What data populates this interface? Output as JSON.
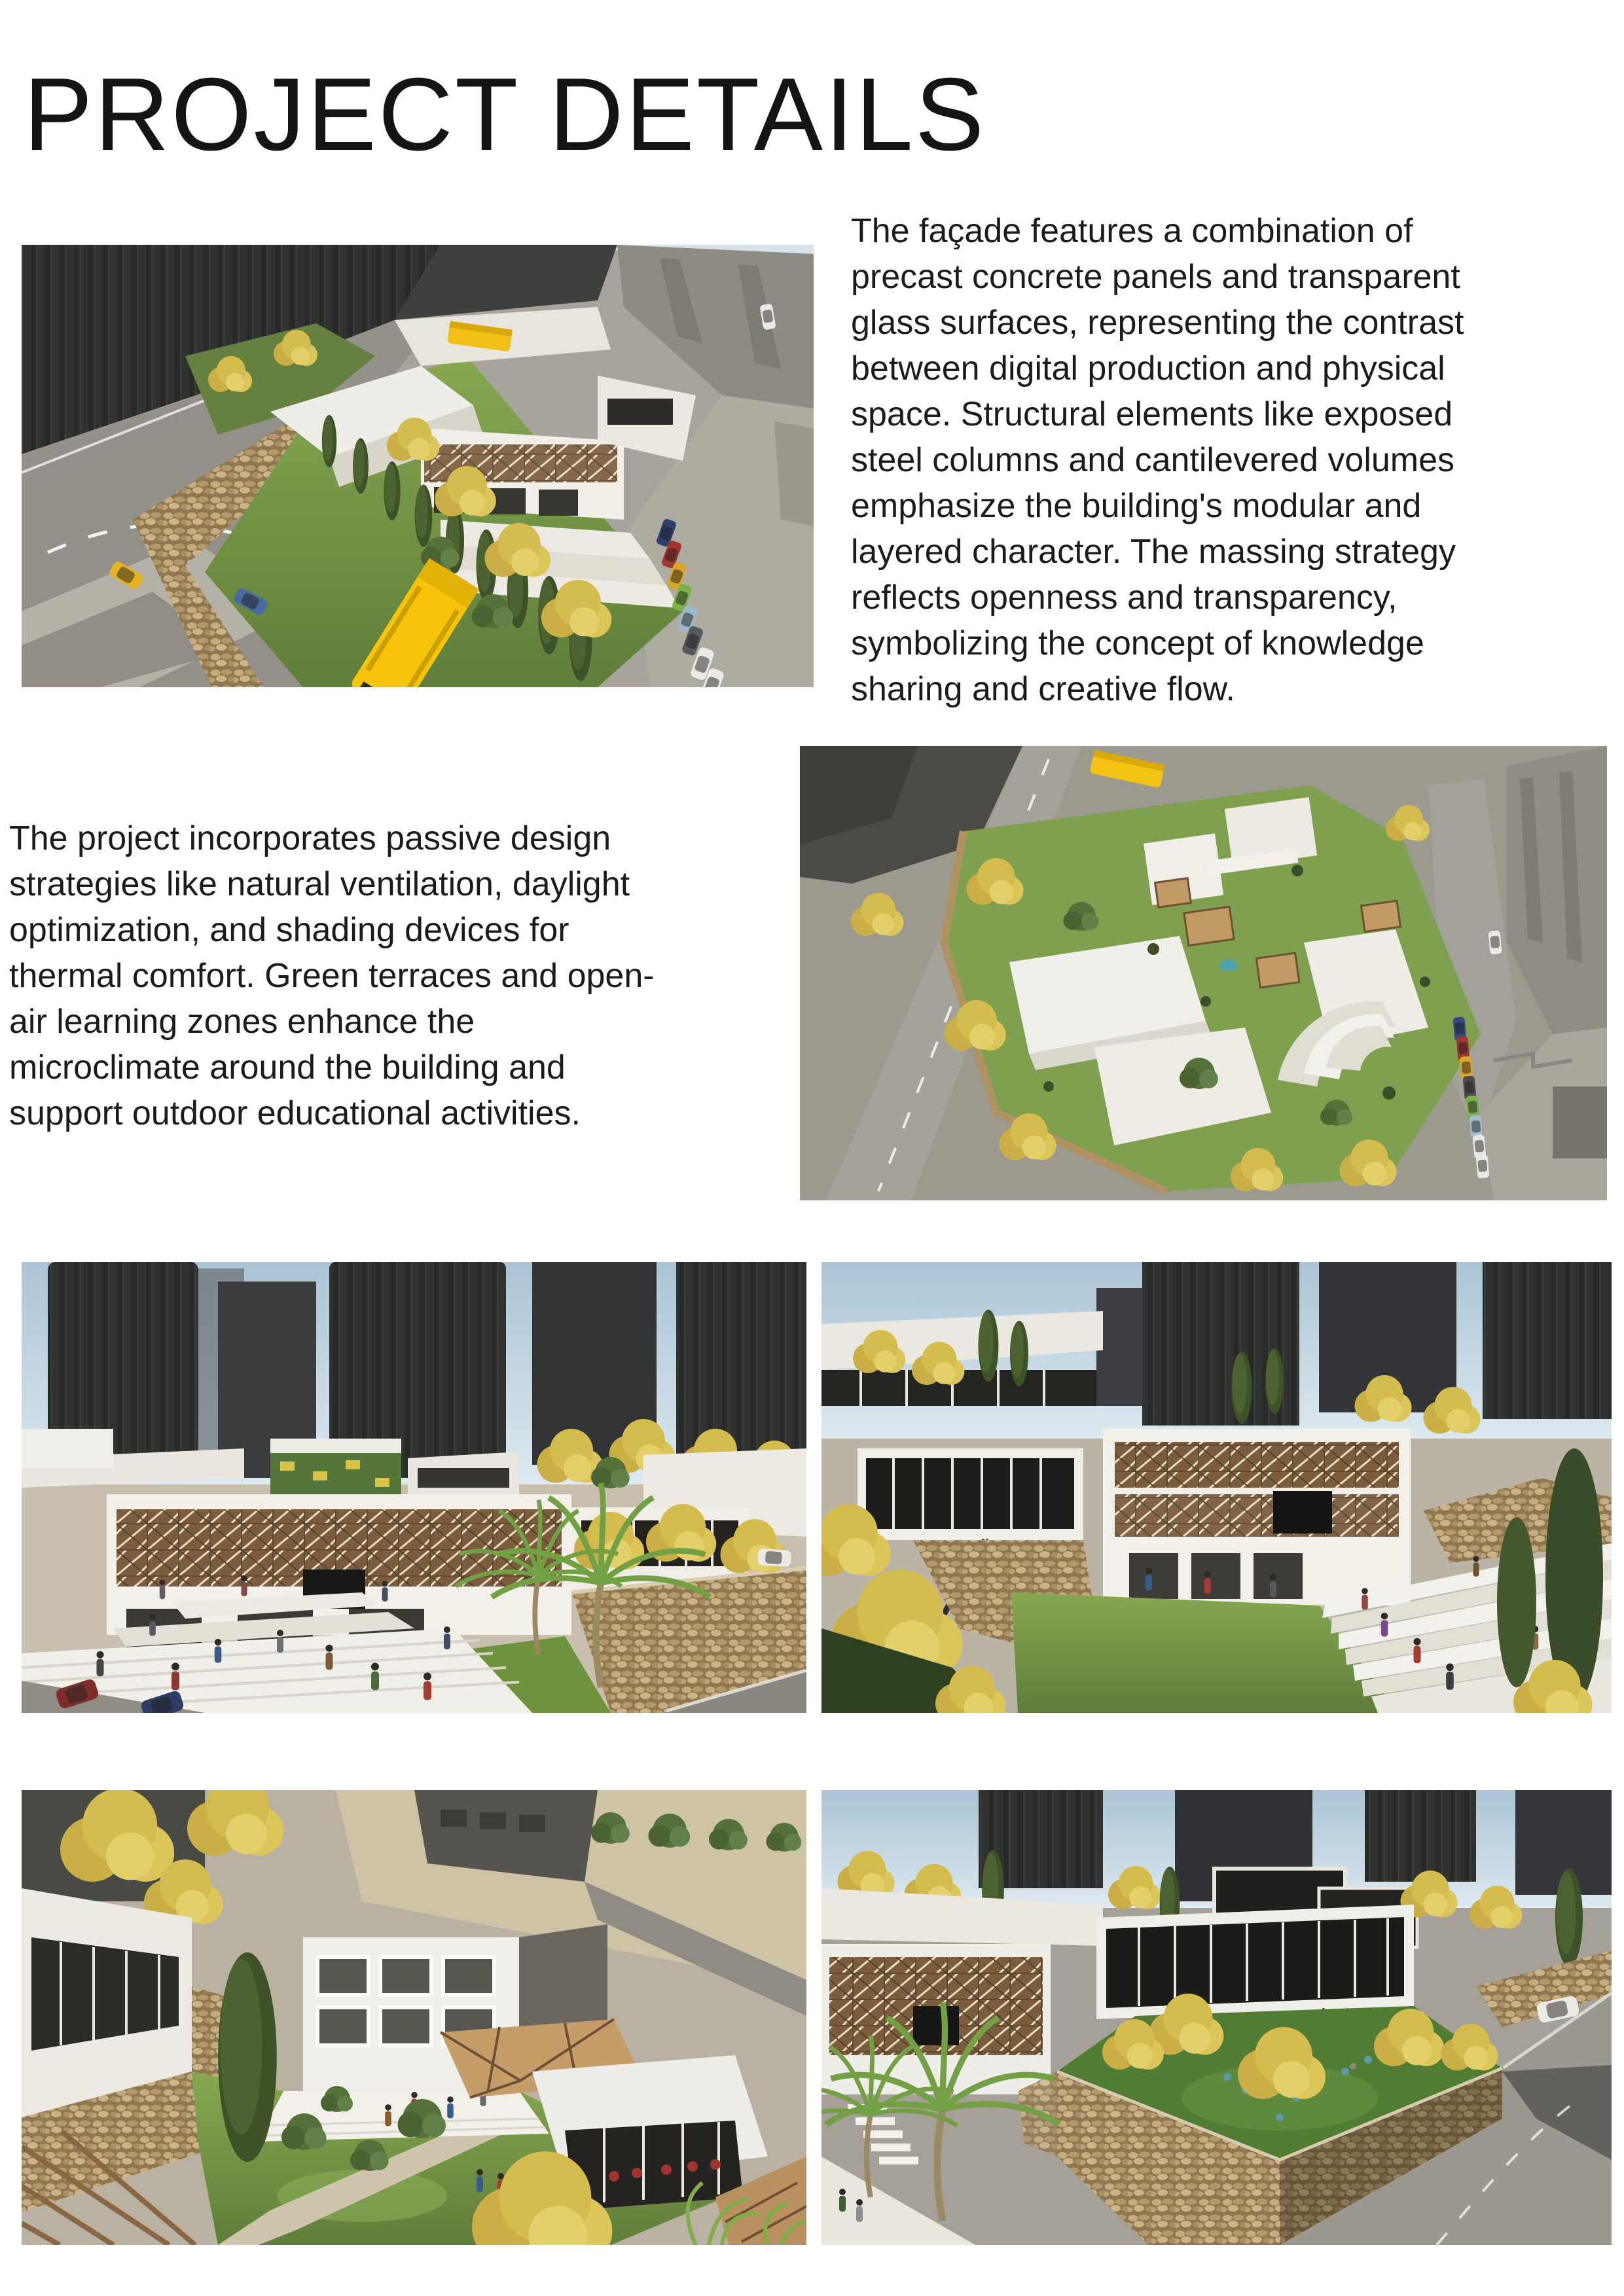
{
  "page": {
    "title": "PROJECT DETAILS"
  },
  "paragraphs": {
    "facade_lines": [
      "The façade features a combination of",
      "precast concrete panels and transparent",
      "glass surfaces, representing the contrast",
      "between digital production and physical",
      "space. Structural elements like exposed",
      "steel columns and cantilevered volumes",
      "emphasize the building's modular and",
      "layered character. The massing strategy",
      "reflects openness and transparency,",
      "symbolizing the concept of knowledge",
      "sharing and creative flow."
    ],
    "passive_lines": [
      "The project incorporates passive design",
      "strategies like natural ventilation, daylight",
      "optimization, and shading devices for",
      "thermal comfort. Green terraces and open-",
      "air learning zones enhance the",
      "microclimate around the building and",
      "support outdoor educational activities."
    ]
  },
  "images": {
    "aerial_street": {
      "alt": "Aerial rendering of the hillside school site along a road with a yellow school bus, taxi, cypress trees, stone walls and parked cars"
    },
    "aerial_top": {
      "alt": "Top-down aerial rendering of the campus with white angular roofs, green courtyards, wooden pergolas, amphitheater steps and surrounding streets"
    },
    "plaza_steps": {
      "alt": "Entrance plaza rendering with tiered white amphitheater steps, people, palm trees and wooden lattice facade under city towers"
    },
    "amphitheater": {
      "alt": "Elevated rendering of amphitheater seating beside a lawn, with a cantilevered glass volume on steel struts over a stone wall"
    },
    "courtyard": {
      "alt": "Inner courtyard rendering with lawn, stone path, shrubs, tall cypress, yellow tree and classroom wings with triangulated pergola roofs"
    },
    "terrace_garden": {
      "alt": "Stone-walled terrace garden rendering with outdoor cafe seating under yellow trees, a cantilevered glass volume and a curving road"
    }
  },
  "colors": {
    "background": "#ffffff",
    "title_text": "#141414",
    "body_text": "#1b1b1b",
    "bus_yellow": "#f6c50a",
    "grass_green": "#7fa04f",
    "stone_tan": "#b5986a",
    "wood_brown": "#7b5c3d",
    "sky_blue": "#b9cedb",
    "building_white": "#f1efe8",
    "tower_dark": "#303230"
  }
}
